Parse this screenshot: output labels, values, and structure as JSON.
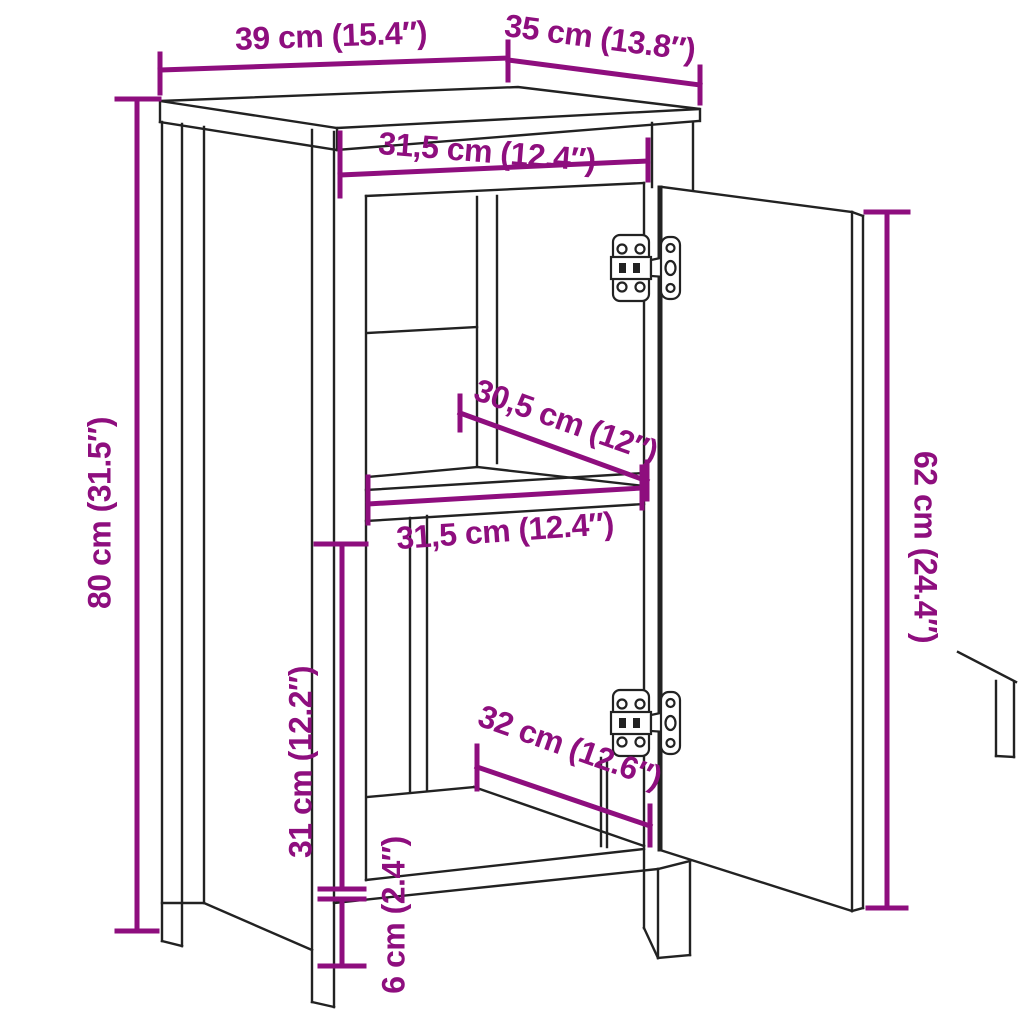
{
  "diagram": {
    "type": "furniture-dimension-drawing",
    "subject": "cabinet-with-open-door-shelf-and-hinges",
    "colors": {
      "background": "#ffffff",
      "line": "#222222",
      "dimension": "#8e0e7e"
    },
    "dimensions": {
      "top_width": "39 cm (15.4″)",
      "top_depth": "35 cm (13.8″)",
      "opening_width_top": "31,5 cm (12.4″)",
      "shelf_depth": "30,5 cm (12″)",
      "opening_width_middle": "31,5 cm (12.4″)",
      "door_height": "62 cm (24.4″)",
      "total_height": "80 cm (31.5″)",
      "lower_compartment_height": "31 cm (12.2″)",
      "interior_depth": "32 cm (12.6″)",
      "plinth_height": "6 cm (2.4″)"
    }
  }
}
